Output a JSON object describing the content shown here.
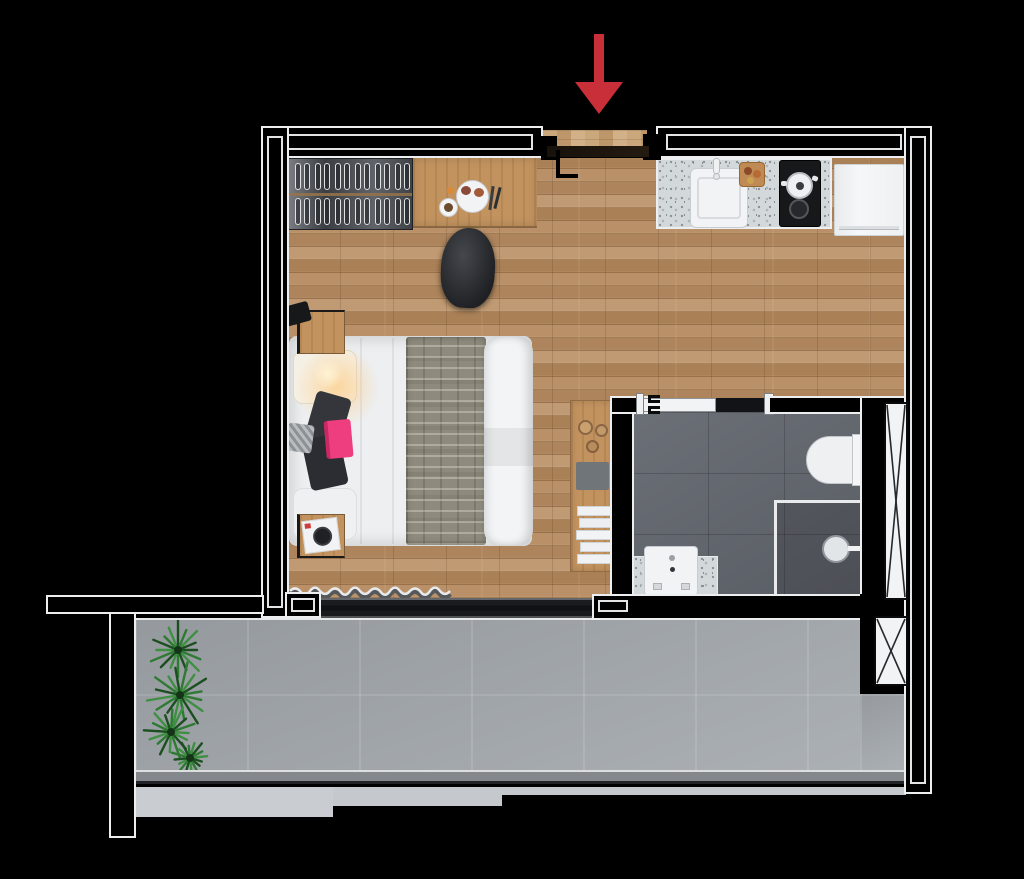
{
  "image": {
    "kind": "top-down 3D rendered floor plan of a studio apartment",
    "background": "#000000",
    "visible_text": "none"
  },
  "colors": {
    "wall_fill": "#000000",
    "wall_outline": "#eceeef",
    "wood_floor": "#b58d64",
    "entry_wood": "#c7a578",
    "bathroom_tile": "#63676e",
    "shower_tile": "#565a61",
    "balcony_tile": "#a6abb0",
    "concrete_ledge": "#c9cdd1",
    "railing": "#84888d",
    "granite_counter": "#d3d8da",
    "cooktop_black": "#17181a",
    "appliance_white": "#f3f4f6",
    "wardrobe_gray": "#4a4e54",
    "bed_linen": "#edeff1",
    "blanket_taupe": "#8e8b7e",
    "accent_pink": "#ee3e7f",
    "plant_green": "#2e7a33",
    "plant_green_dark": "#1c4f20",
    "arrow_red": "#c92f38",
    "glass_dark": "#17191c",
    "wood_furniture": "#c2935f"
  },
  "entrance": {
    "indicator": "red arrow pointing down at top of plan",
    "door": "entry door leaf drawn closed across opening with black handle"
  },
  "rooms": [
    {
      "name": "living-sleeping-area",
      "floor": "light oak plank flooring",
      "features": [
        "wardrobe-with-hangers",
        "dining-table-with-breakfast",
        "chair",
        "double-bed",
        "gray-patterned-blanket",
        "pillows",
        "dark-garment",
        "pink-accent-item",
        "wall-lamp-glow",
        "nightstand-top",
        "nightstand-bottom-with-record",
        "console-shelf-with-bowls-tablet-books",
        "curtain-at-window"
      ]
    },
    {
      "name": "kitchenette",
      "features": [
        "granite-counter",
        "sink-with-faucet",
        "cutting-board",
        "two-burner-cooktop",
        "pot-on-burner",
        "refrigerator"
      ]
    },
    {
      "name": "bathroom",
      "floor": "dark gray tile",
      "features": [
        "sliding-door",
        "toilet",
        "walk-in-shower-with-glass-partition",
        "shower-head",
        "vanity-granite-top",
        "vanity-sink"
      ]
    },
    {
      "name": "balcony",
      "floor": "large concrete tiles",
      "features": [
        "tall-potted-plant",
        "glass-railing",
        "sliding-glass-door",
        "stepped-concrete-ledge"
      ]
    }
  ],
  "shafts": [
    {
      "name": "duct-shaft-tall",
      "symbol": "white box with X",
      "location": "right of bathroom"
    },
    {
      "name": "duct-shaft-small",
      "symbol": "white box with X",
      "location": "right of balcony"
    }
  ]
}
